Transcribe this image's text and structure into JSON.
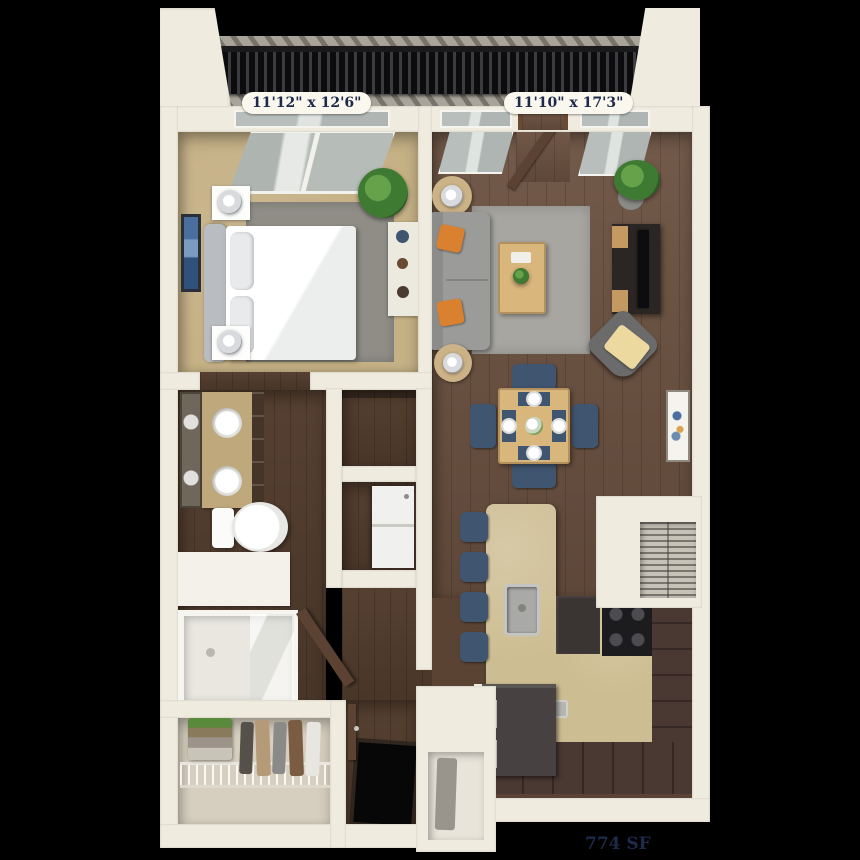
{
  "floorplan": {
    "area_label": "774 SF",
    "rooms": {
      "bedroom": {
        "dimensions": "11'12\" x 12'6\""
      },
      "living_room": {
        "dimensions": "11'10\" x 17'3\""
      }
    }
  },
  "colors": {
    "background": "#000000",
    "wall": "#f0ebdf",
    "label-bg": "#faf7ef",
    "label-text": "#1e2a4a",
    "carpet": "#c6b186",
    "wood": "#6b5140",
    "wood-dark": "#5a4333",
    "rug-bedroom": "#8f8d86",
    "rug-living": "#a8a6a1",
    "sofa": "#9b9b99",
    "accent-orange": "#d9812f",
    "navy": "#3f5570",
    "counter-tan": "#cdbd92",
    "cabinet-brown": "#4a3832",
    "table-wood": "#d8b67c",
    "white-fixture": "#fdfdfb",
    "plant-green": "#3f7a33",
    "balcony-floor": "#a9a49a",
    "railing": "#222224",
    "glass": "#c3cac7",
    "closet-floor": "#d6cfbf",
    "door-brown": "#5b4232"
  }
}
